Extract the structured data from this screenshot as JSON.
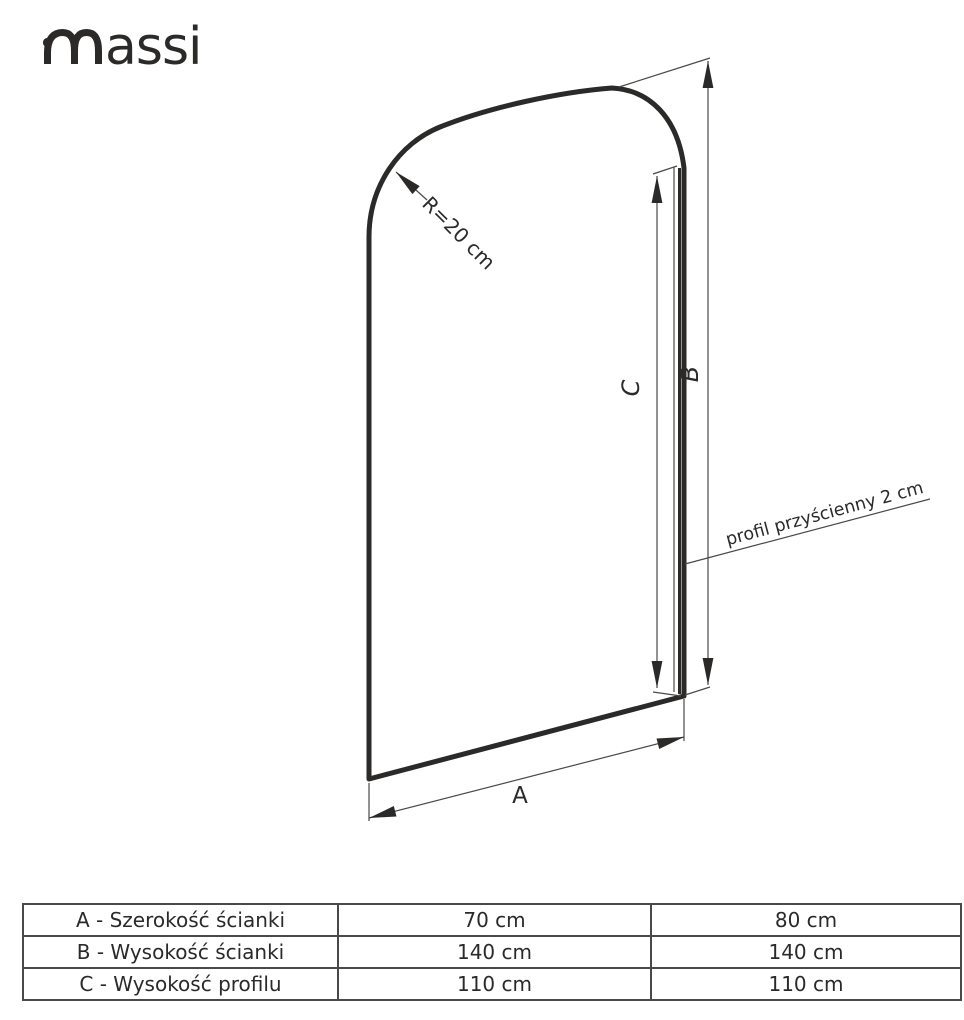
{
  "logo": {
    "brand": "massi",
    "tail": "assi"
  },
  "diagram": {
    "radius_label": "R=20 cm",
    "profile_label": "profil przyścienny 2 cm",
    "dim_a_label": "A",
    "dim_b_label": "B",
    "dim_c_label": "C"
  },
  "table": {
    "rows": [
      {
        "name": "A - Szerokość ścianki",
        "size1": "70 cm",
        "size2": "80 cm"
      },
      {
        "name": "B - Wysokość ścianki",
        "size1": "140 cm",
        "size2": "140 cm"
      },
      {
        "name": "C - Wysokość profilu",
        "size1": "110 cm",
        "size2": "110 cm"
      }
    ]
  },
  "colors": {
    "ink": "#2b2a29",
    "thin_line": "#4a4948",
    "background": "#ffffff"
  }
}
